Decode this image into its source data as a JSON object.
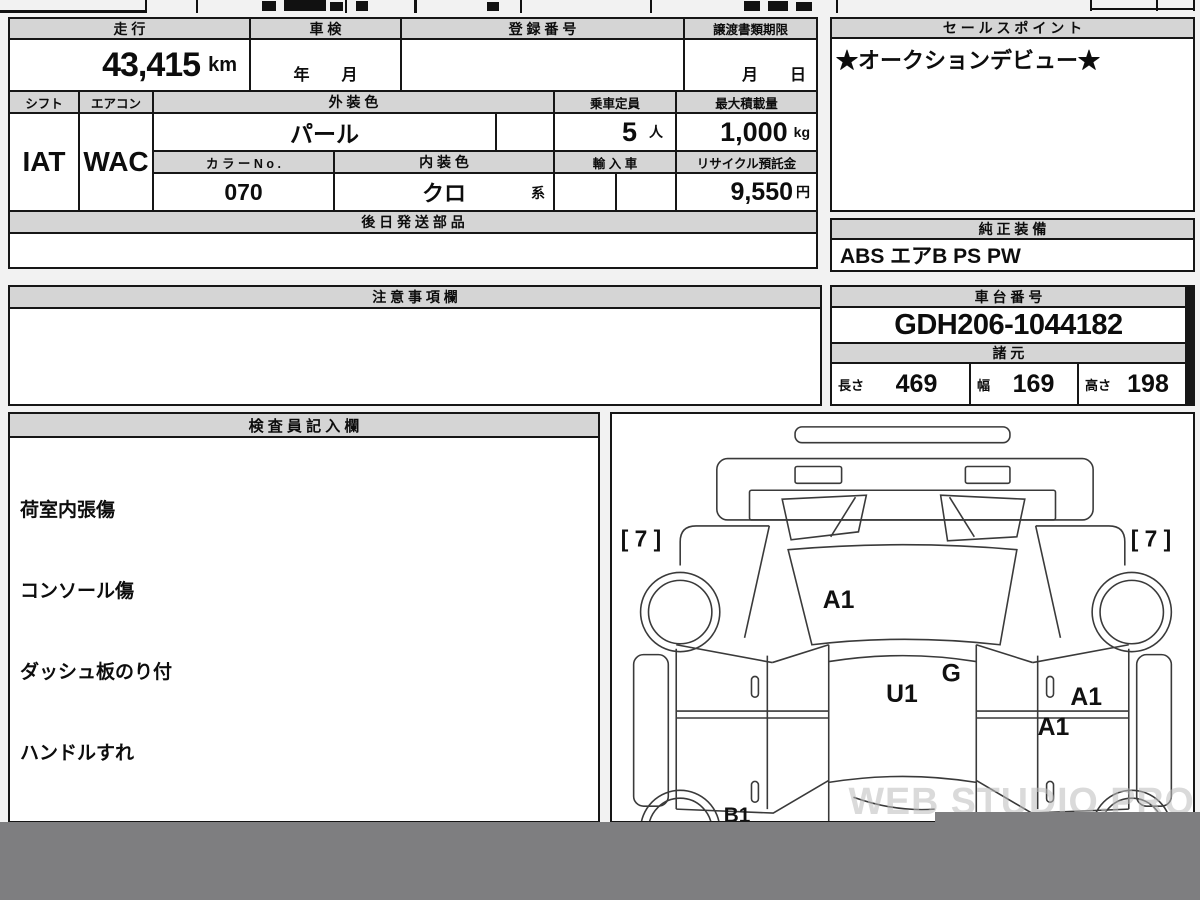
{
  "colors": {
    "header_bg": "#d5d5d5",
    "border": "#161616",
    "censor_band": "#7e7e80",
    "watermark_gray": "#bdbdbd"
  },
  "mileage": {
    "label": "走 行",
    "value": "43,415",
    "unit": "km"
  },
  "shaken": {
    "label": "車 検",
    "value": "年　　月"
  },
  "registration": {
    "label": "登 録 番 号",
    "value": ""
  },
  "transfer_docs": {
    "label": "譲渡書類期限",
    "value": "月　　日"
  },
  "sales_point": {
    "label": "セ ー ル ス ポ イ ン ト",
    "value": "★オークションデビュー★"
  },
  "shift": {
    "label": "シフト",
    "value": "IAT"
  },
  "aircon": {
    "label": "エアコン",
    "value": "WAC"
  },
  "exterior_color": {
    "label": "外 装 色",
    "value": "パール"
  },
  "capacity": {
    "label": "乗車定員",
    "value": "5",
    "unit": "人"
  },
  "max_load": {
    "label": "最大積載量",
    "value": "1,000",
    "unit": "kg"
  },
  "color_no": {
    "label": "カ ラ ー N o .",
    "value": "070"
  },
  "interior_color": {
    "label": "内 装 色",
    "value": "クロ",
    "suffix": "系"
  },
  "import_car": {
    "label": "輸 入 車",
    "value": ""
  },
  "recycle_deposit": {
    "label": "リサイクル預託金",
    "value": "9,550",
    "unit": "円"
  },
  "later_shipped_parts": {
    "label": "後 日 発 送 部 品",
    "value": ""
  },
  "genuine_equipment": {
    "label": "純 正 装 備",
    "value": "ABS エアB PS PW"
  },
  "caution_notes": {
    "label": "注 意 事 項 欄",
    "value": ""
  },
  "chassis_no": {
    "label": "車 台 番 号",
    "value": "GDH206-1044182"
  },
  "specs": {
    "label": "諸 元",
    "dims": [
      {
        "label": "長さ",
        "value": "469"
      },
      {
        "label": "幅",
        "value": "169"
      },
      {
        "label": "高さ",
        "value": "198"
      }
    ]
  },
  "inspector_notes": {
    "label": "検 査 員 記 入 欄",
    "items": [
      "荷室内張傷",
      "コンソール傷",
      "ダッシュ板のり付",
      "ハンドルすれ",
      "ホイールカバー A"
    ]
  },
  "diagram": {
    "tire_left": "[ 7 ]",
    "tire_right": "[ 7 ]",
    "marks": {
      "windshield": "A1",
      "glass": "G",
      "roof": "U1",
      "right_door_upper": "A1",
      "right_door_lower": "A1",
      "rear_left": "B1"
    },
    "watermark": "WEB STUDIO.PRO"
  }
}
